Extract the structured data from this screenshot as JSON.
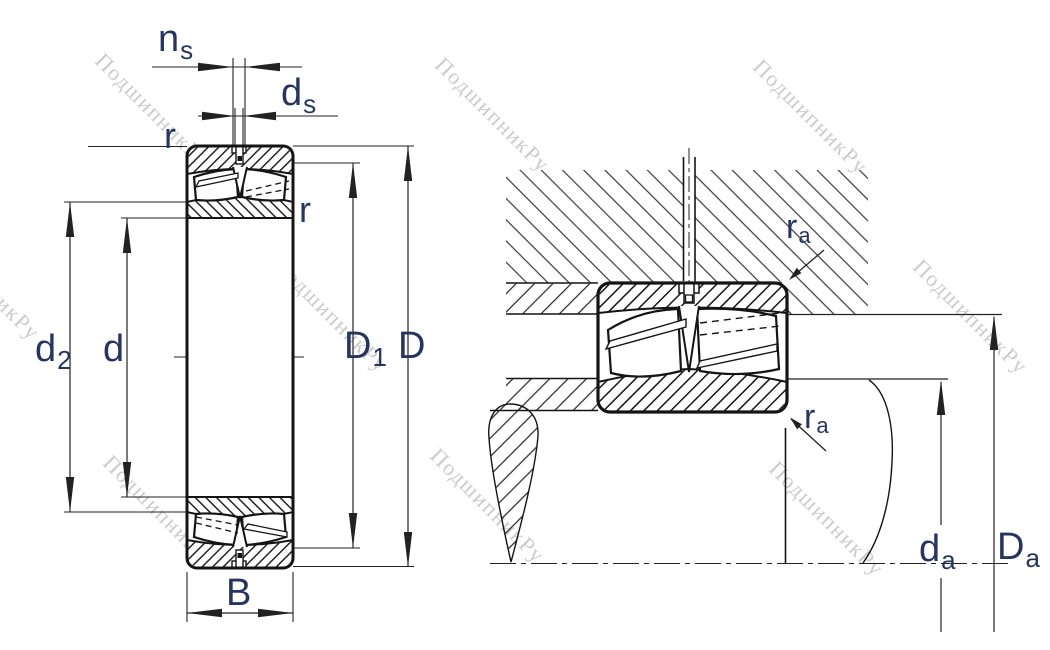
{
  "figure": {
    "type": "bearing-technical-drawing",
    "description": "Spherical roller bearing: dimensioned cross-section (left) and mounting/abutment drawing (right)",
    "background": "#ffffff",
    "line_color": "#141414",
    "dimension_color": "#222222",
    "label_color": "#25355f",
    "watermark": {
      "text": "ПодшипникРу",
      "color": "#c3c3c3"
    }
  },
  "labels": {
    "ns": {
      "main": "n",
      "sub": "s"
    },
    "ds": {
      "main": "d",
      "sub": "s"
    },
    "r_top_left": {
      "main": "r",
      "sub": ""
    },
    "r_right": {
      "main": "r",
      "sub": ""
    },
    "d2": {
      "main": "d",
      "sub": "2"
    },
    "d": {
      "main": "d",
      "sub": ""
    },
    "D1": {
      "main": "D",
      "sub": "1"
    },
    "D": {
      "main": "D",
      "sub": ""
    },
    "B": {
      "main": "B",
      "sub": ""
    },
    "ra_upper": {
      "main": "r",
      "sub": "a"
    },
    "ra_lower": {
      "main": "r",
      "sub": "a"
    },
    "da": {
      "main": "d",
      "sub": "a"
    },
    "Da": {
      "main": "D",
      "sub": "a"
    }
  }
}
